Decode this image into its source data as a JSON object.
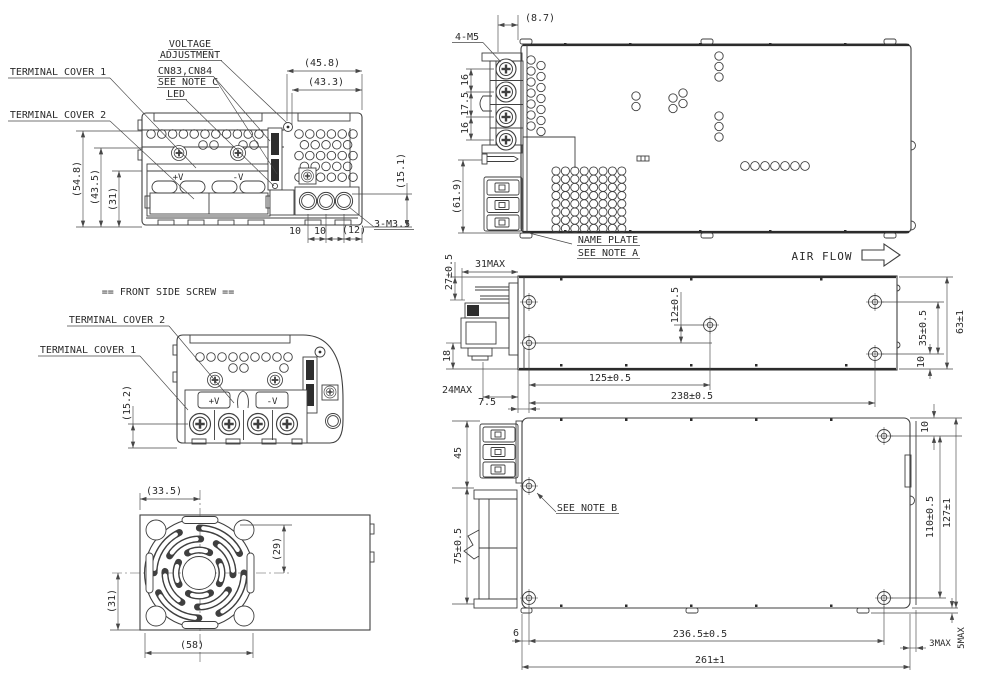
{
  "drawing": {
    "front_view": {
      "callouts": {
        "voltage_line1": "VOLTAGE",
        "voltage_line2": "ADJUSTMENT",
        "connector": "CN83,CN84",
        "connector_note": "SEE NOTE C",
        "led": "LED",
        "terminal_cover_1": "TERMINAL COVER 1",
        "terminal_cover_2": "TERMINAL COVER 2",
        "screw_spec": "3-M3.5"
      },
      "terminals": {
        "positive": "+V",
        "negative": "-V"
      },
      "dims": {
        "width_outer": "(45.8)",
        "width_inner": "(43.3)",
        "height_outer": "(54.8)",
        "height_mid": "(43.5)",
        "height_inner": "(31)",
        "terminal_height": "(15.1)",
        "pitch_left": "10",
        "pitch_right": "10",
        "edge_offset": "(12)"
      }
    },
    "screw_view": {
      "title": "== FRONT SIDE SCREW ==",
      "callouts": {
        "terminal_cover_2": "TERMINAL COVER 2",
        "terminal_cover_1": "TERMINAL COVER 1"
      },
      "terminals": {
        "positive": "+V",
        "negative": "-V"
      },
      "dims": {
        "screw_height": "(15.2)"
      }
    },
    "fan_view": {
      "dims": {
        "center_x": "(33.5)",
        "hole_offset": "(29)",
        "center_y": "(31)",
        "width": "(58)"
      }
    },
    "top_view": {
      "callouts": {
        "screw_spec": "4-M5",
        "name_plate_line1": "NAME PLATE",
        "name_plate_line2": "SEE NOTE A",
        "air_flow": "AIR FLOW"
      },
      "dims": {
        "terminal_offset": "(8.7)",
        "pitch_top": "16",
        "pitch_middle": "17.5",
        "pitch_bottom": "16",
        "depth": "(61.9)"
      }
    },
    "side_view": {
      "dims": {
        "connector_height": "27±0.5",
        "connector_depth": "31MAX",
        "hole_offset": "12±0.5",
        "lower_height": "18",
        "connector_bottom": "24MAX",
        "front_offset": "7.5",
        "hole_pitch_mid": "125±0.5",
        "hole_pitch": "238±0.5",
        "hole_pitch_v": "35±0.5",
        "height": "63±1",
        "bottom_offset": "10"
      }
    },
    "bottom_view": {
      "callouts": {
        "note_b": "SEE NOTE B"
      },
      "dims": {
        "connector_height": "45",
        "bracket_height": "75±0.5",
        "front_offset": "6",
        "hole_pitch": "236.5±0.5",
        "width": "261±1",
        "side_clearance": "3MAX",
        "foot_clearance": "5MAX",
        "top_offset": "10",
        "hole_pitch_v": "110±0.5",
        "height": "127±1"
      }
    }
  }
}
